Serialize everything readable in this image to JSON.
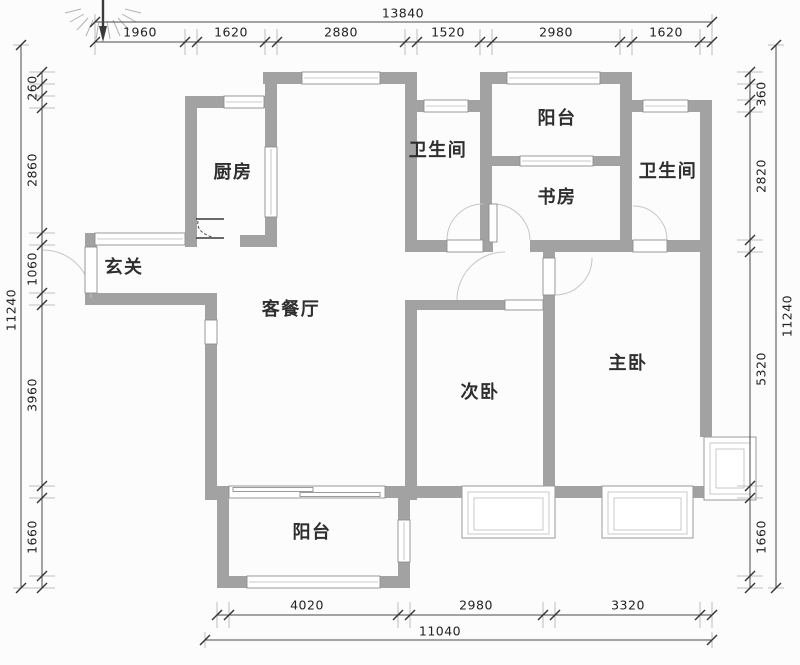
{
  "plan": {
    "compass_icon": "north-compass-icon",
    "rooms": [
      {
        "id": "kitchen",
        "label": "厨房"
      },
      {
        "id": "bath-1",
        "label": "卫生间"
      },
      {
        "id": "balcony-top",
        "label": "阳台"
      },
      {
        "id": "study",
        "label": "书房"
      },
      {
        "id": "bath-2",
        "label": "卫生间"
      },
      {
        "id": "entry",
        "label": "玄关"
      },
      {
        "id": "living-dining",
        "label": "客餐厅"
      },
      {
        "id": "bedroom-second",
        "label": "次卧"
      },
      {
        "id": "master-bedroom",
        "label": "主卧"
      },
      {
        "id": "balcony-bottom",
        "label": "阳台"
      }
    ],
    "dimensions": {
      "top": {
        "total": "13840",
        "segments": [
          "1960",
          "1620",
          "2880",
          "1520",
          "2980",
          "1620"
        ]
      },
      "left": {
        "total": "11240",
        "segments": [
          "260",
          "2860",
          "1060",
          "3960",
          "1660"
        ]
      },
      "right": {
        "total": "11240",
        "segments": [
          "360",
          "2820",
          "5320",
          "1660"
        ]
      },
      "bottom": {
        "total": "11040",
        "segments": [
          "4020",
          "2980",
          "3320"
        ]
      }
    },
    "colors": {
      "wall": "#a2a2a2",
      "dimension_line": "#4a4a4a",
      "door_arc": "#c6c6c6",
      "background": "#fcfcfc"
    }
  }
}
